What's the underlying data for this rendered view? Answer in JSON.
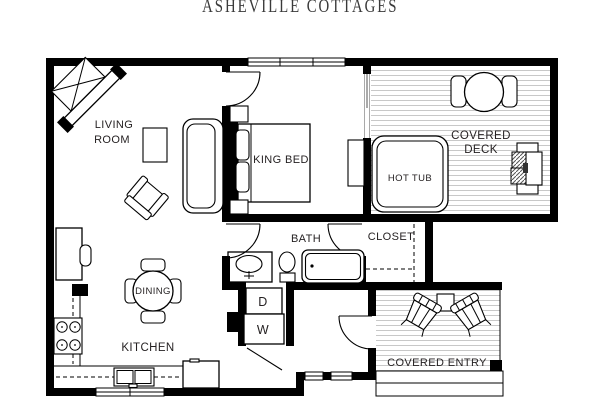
{
  "title": "ASHEVILLE COTTAGES",
  "rooms": {
    "living_room": {
      "line1": "LIVING",
      "line2": "ROOM"
    },
    "bedroom": {
      "bed_label": "KING BED"
    },
    "deck": {
      "line1": "COVERED",
      "line2": "DECK",
      "hot_tub_label": "HOT TUB"
    },
    "bath": {
      "label": "BATH"
    },
    "closet": {
      "label": "CLOSET"
    },
    "kitchen": {
      "label": "KITCHEN"
    },
    "dining": {
      "label": "DINING"
    },
    "entry": {
      "label": "COVERED ENTRY"
    },
    "laundry": {
      "dryer": "D",
      "washer": "W"
    }
  },
  "furniture_items": [
    "corner-fireplace",
    "sofa",
    "armchair",
    "coffee-table",
    "desk",
    "desk-chair",
    "dining-table",
    "dining-chairs",
    "range-stove",
    "kitchen-sink",
    "refrigerator",
    "king-bed",
    "nightstands",
    "dresser",
    "vanity-sink",
    "toilet",
    "bathtub",
    "washer",
    "dryer",
    "hot-tub",
    "deck-table",
    "deck-chairs",
    "grill",
    "adirondack-chairs",
    "side-table",
    "entry-steps"
  ],
  "colors": {
    "wall": "#000000",
    "background": "#ffffff",
    "deck_stripe": "#c8c8c8",
    "text": "#231f20",
    "title_text": "#3a3a3a"
  }
}
